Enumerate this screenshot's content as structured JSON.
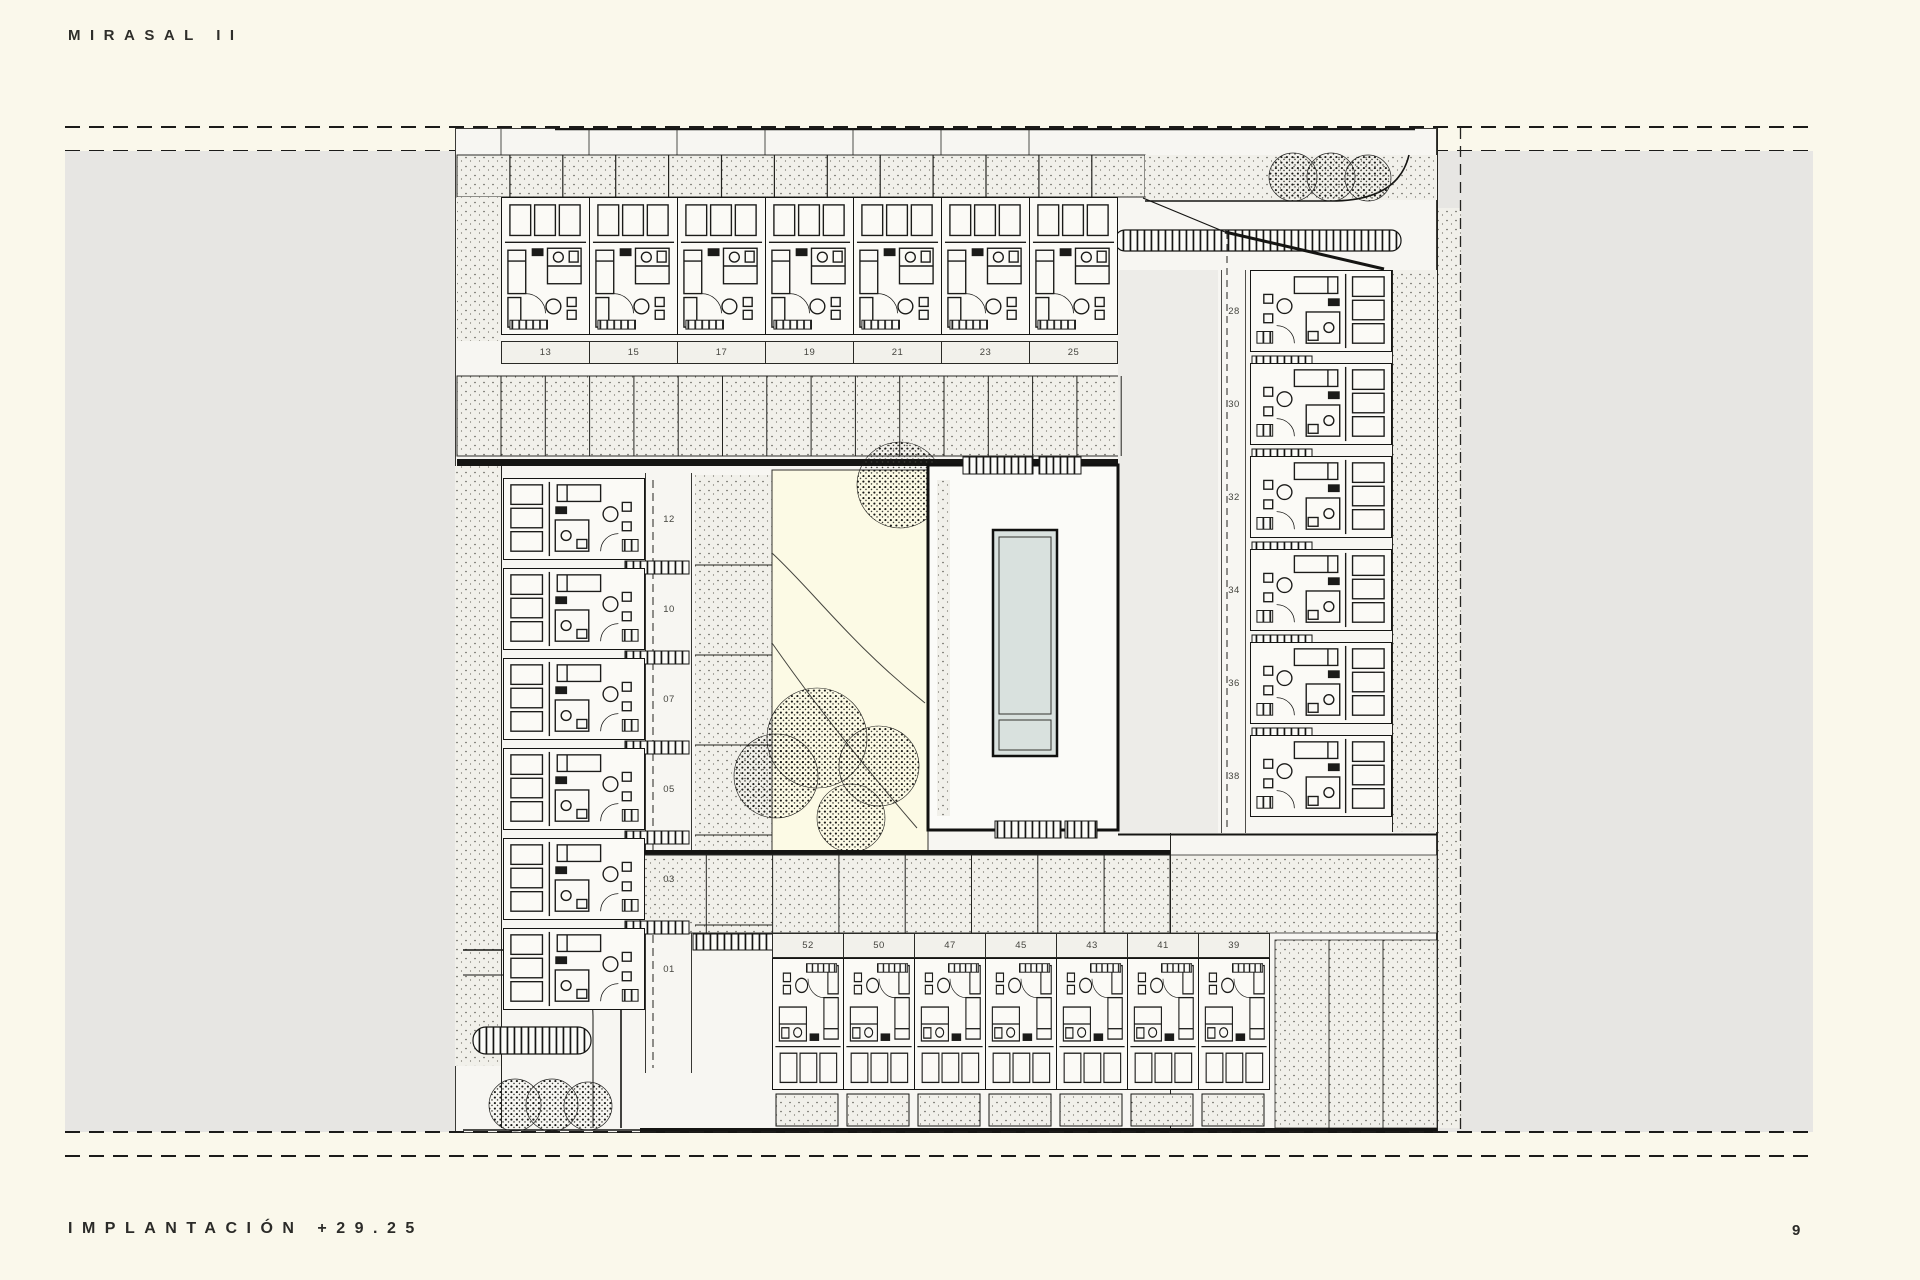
{
  "page": {
    "title": "MIRASAL II",
    "footer": "IMPLANTACIÓN +29.25",
    "page_number": "9"
  },
  "colors": {
    "paper": "#FAF8EB",
    "canvas_grey": "#E7E6E3",
    "paving": "#F1F0EA",
    "garden": "#FCFAE5",
    "pool_water": "#D9E1DE",
    "ink": "#1B1B19",
    "label": "#45453F"
  },
  "plan": {
    "unit_rows": {
      "north": {
        "units": [
          "13",
          "15",
          "17",
          "19",
          "21",
          "23",
          "25"
        ]
      },
      "west": {
        "units": [
          "12",
          "10",
          "07",
          "05",
          "03",
          "01"
        ]
      },
      "east": {
        "units": [
          "28",
          "30",
          "32",
          "34",
          "36",
          "38"
        ]
      },
      "south": {
        "units": [
          "52",
          "50",
          "47",
          "45",
          "43",
          "41",
          "39"
        ]
      }
    },
    "tree_groups": {
      "north_east_count": 3,
      "garden_count": 5,
      "south_west_count": 3
    }
  }
}
